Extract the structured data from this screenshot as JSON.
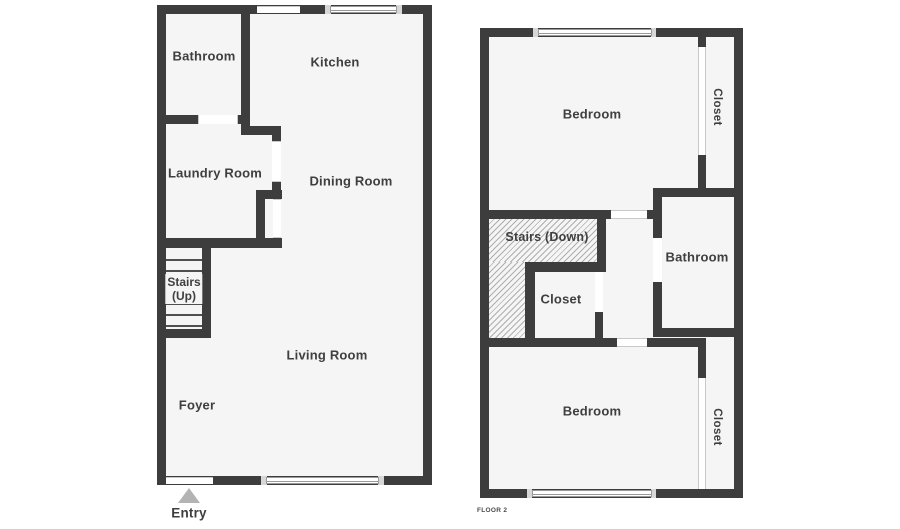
{
  "colors": {
    "wall": "#3d3d3d",
    "room_fill": "#f5f5f5",
    "canvas": "#ffffff",
    "label_text": "#3f3f3f",
    "hatch_line": "#aeaeae",
    "window_line": "#9a9a9a",
    "window_cap": "#d7d7d7",
    "opening_line": "#c8c8c8",
    "entry_arrow": "#b3b3b3",
    "tread_line": "#4f4f4f",
    "floor_tag_text": "#4a4a4a"
  },
  "floor1": {
    "rooms": {
      "bathroom": "Bathroom",
      "kitchen": "Kitchen",
      "laundry": "Laundry Room",
      "dining": "Dining Room",
      "stairs_line1": "Stairs",
      "stairs_line2": "(Up)",
      "living": "Living Room",
      "foyer": "Foyer"
    },
    "entry_label": "Entry"
  },
  "floor2": {
    "rooms": {
      "bedroom_top": "Bedroom",
      "closet_top": "Closet",
      "stairs": "Stairs (Down)",
      "bathroom": "Bathroom",
      "closet_mid": "Closet",
      "bedroom_bottom": "Bedroom",
      "closet_bottom": "Closet"
    },
    "floor_tag": "FLOOR 2"
  }
}
